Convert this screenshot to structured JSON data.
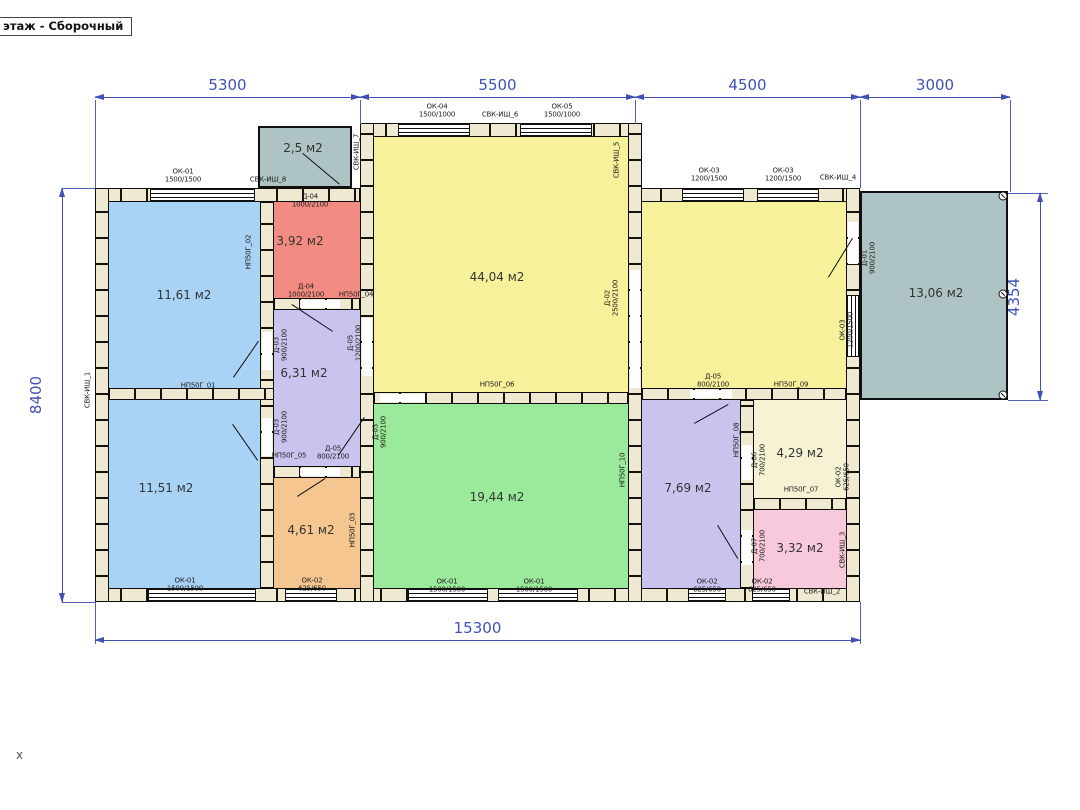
{
  "view_title": "этаж - Сборочный",
  "axis_label": "x",
  "colors": {
    "blue": "#a9d3f5",
    "red": "#f28c82",
    "lavender": "#c9c4ee",
    "orange": "#f6c690",
    "yellow": "#f6f19a",
    "green": "#9bea9b",
    "cream": "#f6f2d4",
    "pink": "#f8c8dc",
    "gray": "#aec3c3",
    "wall": "#efe9d2",
    "dim": "#3f51b5"
  },
  "rooms": [
    {
      "name": "room-11-61",
      "color": "blue",
      "x": 109,
      "y": 202,
      "w": 151,
      "h": 186
    },
    {
      "name": "room-11-51",
      "color": "blue",
      "x": 109,
      "y": 400,
      "w": 151,
      "h": 188
    },
    {
      "name": "room-3-92",
      "color": "red",
      "x": 274,
      "y": 202,
      "w": 86,
      "h": 96
    },
    {
      "name": "room-6-31",
      "color": "lavender",
      "x": 274,
      "y": 310,
      "w": 86,
      "h": 156
    },
    {
      "name": "room-4-61",
      "color": "orange",
      "x": 274,
      "y": 478,
      "w": 86,
      "h": 110
    },
    {
      "name": "room-44-04",
      "color": "yellow",
      "x": 374,
      "y": 137,
      "w": 254,
      "h": 255
    },
    {
      "name": "room-19-44",
      "color": "green",
      "x": 374,
      "y": 404,
      "w": 254,
      "h": 184
    },
    {
      "name": "room-right-hall",
      "color": "yellow",
      "x": 642,
      "y": 202,
      "w": 204,
      "h": 186
    },
    {
      "name": "room-7-69",
      "color": "lavender",
      "x": 642,
      "y": 400,
      "w": 98,
      "h": 188
    },
    {
      "name": "room-4-29",
      "color": "cream",
      "x": 754,
      "y": 400,
      "w": 92,
      "h": 98
    },
    {
      "name": "room-3-32",
      "color": "pink",
      "x": 754,
      "y": 510,
      "w": 92,
      "h": 78
    }
  ],
  "outbuildings": [
    {
      "name": "terrace",
      "color": "gray",
      "x": 860,
      "y": 191,
      "w": 148,
      "h": 209
    },
    {
      "name": "porch",
      "color": "gray",
      "x": 258,
      "y": 126,
      "w": 94,
      "h": 62
    }
  ],
  "walls": [
    {
      "name": "wall-top-left",
      "d": "h",
      "x": 95,
      "y": 188,
      "w": 265,
      "h": 14
    },
    {
      "name": "wall-top-center",
      "d": "h",
      "x": 360,
      "y": 123,
      "w": 275,
      "h": 14
    },
    {
      "name": "wall-top-right",
      "d": "h",
      "x": 635,
      "y": 188,
      "w": 225,
      "h": 14
    },
    {
      "name": "wall-bottom",
      "d": "h",
      "x": 95,
      "y": 588,
      "w": 765,
      "h": 14
    },
    {
      "name": "wall-left",
      "d": "v",
      "x": 95,
      "y": 188,
      "w": 14,
      "h": 414
    },
    {
      "name": "wall-right",
      "d": "v",
      "x": 846,
      "y": 188,
      "w": 14,
      "h": 414
    },
    {
      "name": "wall-center-left",
      "d": "v",
      "x": 360,
      "y": 123,
      "w": 14,
      "h": 479
    },
    {
      "name": "wall-center-right",
      "d": "v",
      "x": 628,
      "y": 123,
      "w": 14,
      "h": 479
    },
    {
      "name": "wall-left-mid",
      "d": "v",
      "x": 260,
      "y": 202,
      "w": 14,
      "h": 386
    },
    {
      "name": "wall-blue-divider",
      "d": "h",
      "x": 109,
      "y": 388,
      "w": 165,
      "h": 12
    },
    {
      "name": "wall-red-hall",
      "d": "h",
      "x": 274,
      "y": 298,
      "w": 86,
      "h": 12
    },
    {
      "name": "wall-hall-orange",
      "d": "h",
      "x": 274,
      "y": 466,
      "w": 86,
      "h": 12
    },
    {
      "name": "wall-yellow-green",
      "d": "h",
      "x": 374,
      "y": 392,
      "w": 254,
      "h": 12
    },
    {
      "name": "wall-right-mid-h",
      "d": "h",
      "x": 642,
      "y": 388,
      "w": 204,
      "h": 12
    },
    {
      "name": "wall-right-mid-v",
      "d": "v",
      "x": 740,
      "y": 400,
      "w": 14,
      "h": 188
    },
    {
      "name": "wall-cream-pink",
      "d": "h",
      "x": 754,
      "y": 498,
      "w": 92,
      "h": 12
    }
  ],
  "windows": [
    {
      "d": "h",
      "x": 150,
      "y": 189,
      "w": 105,
      "h": 12
    },
    {
      "d": "h",
      "x": 398,
      "y": 124,
      "w": 72,
      "h": 12
    },
    {
      "d": "h",
      "x": 520,
      "y": 124,
      "w": 72,
      "h": 12
    },
    {
      "d": "h",
      "x": 682,
      "y": 189,
      "w": 62,
      "h": 12
    },
    {
      "d": "h",
      "x": 757,
      "y": 189,
      "w": 62,
      "h": 12
    },
    {
      "d": "h",
      "x": 148,
      "y": 589,
      "w": 108,
      "h": 12
    },
    {
      "d": "h",
      "x": 285,
      "y": 589,
      "w": 52,
      "h": 12
    },
    {
      "d": "h",
      "x": 408,
      "y": 589,
      "w": 80,
      "h": 12
    },
    {
      "d": "h",
      "x": 498,
      "y": 589,
      "w": 80,
      "h": 12
    },
    {
      "d": "h",
      "x": 688,
      "y": 589,
      "w": 38,
      "h": 12
    },
    {
      "d": "h",
      "x": 752,
      "y": 589,
      "w": 38,
      "h": 12
    },
    {
      "d": "v",
      "x": 847,
      "y": 295,
      "w": 12,
      "h": 62
    }
  ],
  "door_gaps": [
    {
      "x": 848,
      "y": 222,
      "w": 10,
      "h": 42
    },
    {
      "x": 300,
      "y": 300,
      "w": 40,
      "h": 8
    },
    {
      "x": 362,
      "y": 318,
      "w": 10,
      "h": 58
    },
    {
      "x": 262,
      "y": 332,
      "w": 10,
      "h": 38
    },
    {
      "x": 262,
      "y": 418,
      "w": 10,
      "h": 38
    },
    {
      "x": 300,
      "y": 468,
      "w": 40,
      "h": 8
    },
    {
      "x": 380,
      "y": 394,
      "w": 45,
      "h": 8
    },
    {
      "x": 690,
      "y": 390,
      "w": 42,
      "h": 8
    },
    {
      "x": 630,
      "y": 270,
      "w": 10,
      "h": 118
    },
    {
      "x": 742,
      "y": 445,
      "w": 10,
      "h": 35
    },
    {
      "x": 742,
      "y": 530,
      "w": 10,
      "h": 35
    }
  ],
  "door_swings": [
    [
      303,
      153,
      340,
      184
    ],
    [
      233,
      377,
      258,
      341
    ],
    [
      233,
      424,
      258,
      460
    ],
    [
      292,
      304,
      333,
      331
    ],
    [
      338,
      455,
      364,
      417
    ],
    [
      297,
      496,
      325,
      478
    ],
    [
      828,
      277,
      852,
      238
    ],
    [
      694,
      423,
      728,
      404
    ],
    [
      718,
      525,
      738,
      558
    ]
  ],
  "screws": [
    [
      1003,
      196
    ],
    [
      1003,
      294
    ],
    [
      1003,
      395
    ]
  ],
  "area_labels": [
    {
      "t": "11,61 м2",
      "x": 184,
      "y": 295
    },
    {
      "t": "11,51 м2",
      "x": 166,
      "y": 488
    },
    {
      "t": "3,92 м2",
      "x": 300,
      "y": 241
    },
    {
      "t": "6,31 м2",
      "x": 304,
      "y": 373
    },
    {
      "t": "4,61 м2",
      "x": 311,
      "y": 530
    },
    {
      "t": "44,04 м2",
      "x": 497,
      "y": 277
    },
    {
      "t": "19,44 м2",
      "x": 497,
      "y": 497
    },
    {
      "t": "7,69 м2",
      "x": 688,
      "y": 488
    },
    {
      "t": "4,29 м2",
      "x": 800,
      "y": 453
    },
    {
      "t": "3,32 м2",
      "x": 800,
      "y": 548
    },
    {
      "t": "13,06 м2",
      "x": 936,
      "y": 293
    },
    {
      "t": "2,5 м2",
      "x": 303,
      "y": 148
    }
  ],
  "tag_labels": [
    {
      "t": "ОК-01\n1500/1500",
      "x": 183,
      "y": 176
    },
    {
      "t": "СВК-ИШ_8",
      "x": 268,
      "y": 180
    },
    {
      "t": "СВК-ИШ_7",
      "x": 357,
      "y": 152,
      "v": 1
    },
    {
      "t": "ОК-04\n1500/1000",
      "x": 437,
      "y": 111
    },
    {
      "t": "СВК-ИШ_6",
      "x": 500,
      "y": 115
    },
    {
      "t": "ОК-05\n1500/1000",
      "x": 562,
      "y": 111
    },
    {
      "t": "СВК-ИШ_5",
      "x": 617,
      "y": 160,
      "v": 1
    },
    {
      "t": "ОК-03\n1200/1500",
      "x": 709,
      "y": 175
    },
    {
      "t": "ОК-03\n1200/1500",
      "x": 783,
      "y": 175
    },
    {
      "t": "СВК-ИШ_4",
      "x": 838,
      "y": 178
    },
    {
      "t": "СВК-ИШ_1",
      "x": 88,
      "y": 390,
      "v": 1
    },
    {
      "t": "НП50Г_02",
      "x": 249,
      "y": 252,
      "v": 1
    },
    {
      "t": "Д-04\n1000/2100",
      "x": 310,
      "y": 201
    },
    {
      "t": "НП50Г_01",
      "x": 198,
      "y": 386
    },
    {
      "t": "Д-03\n900/2100",
      "x": 281,
      "y": 345,
      "v": 1
    },
    {
      "t": "Д-03\n900/2100",
      "x": 281,
      "y": 427,
      "v": 1
    },
    {
      "t": "Д-05\n1200/2100",
      "x": 355,
      "y": 343,
      "v": 1
    },
    {
      "t": "Д-04\n1000/2100",
      "x": 306,
      "y": 291
    },
    {
      "t": "НП50Г_04",
      "x": 356,
      "y": 295
    },
    {
      "t": "НП50Г_05",
      "x": 289,
      "y": 456
    },
    {
      "t": "Д-05\n800/2100",
      "x": 333,
      "y": 453
    },
    {
      "t": "НП50Г_03",
      "x": 353,
      "y": 530,
      "v": 1
    },
    {
      "t": "ОК-01\n1500/1500",
      "x": 185,
      "y": 585
    },
    {
      "t": "ОК-02\n625/650",
      "x": 312,
      "y": 585
    },
    {
      "t": "Д-02\n2500/2100",
      "x": 612,
      "y": 298,
      "v": 1
    },
    {
      "t": "НП50Г_06",
      "x": 497,
      "y": 385
    },
    {
      "t": "Д-03\n900/2100",
      "x": 380,
      "y": 432,
      "v": 1
    },
    {
      "t": "ОК-01\n1500/1500",
      "x": 447,
      "y": 586
    },
    {
      "t": "ОК-01\n1500/1500",
      "x": 534,
      "y": 586
    },
    {
      "t": "Д-05\n800/2100",
      "x": 713,
      "y": 381
    },
    {
      "t": "НП50Г_09",
      "x": 791,
      "y": 385
    },
    {
      "t": "НП50Г_10",
      "x": 623,
      "y": 470,
      "v": 1
    },
    {
      "t": "НП50Г_08",
      "x": 737,
      "y": 440,
      "v": 1
    },
    {
      "t": "Д-06\n700/2100",
      "x": 759,
      "y": 460,
      "v": 1
    },
    {
      "t": "НП50Г_07",
      "x": 801,
      "y": 490
    },
    {
      "t": "ОК-02\n625/650",
      "x": 843,
      "y": 477,
      "v": 1
    },
    {
      "t": "Д-07\n700/2100",
      "x": 759,
      "y": 546,
      "v": 1
    },
    {
      "t": "СВК-ИШ_3",
      "x": 843,
      "y": 550,
      "v": 1
    },
    {
      "t": "ОК-02\n625/650",
      "x": 707,
      "y": 586
    },
    {
      "t": "ОК-02\n625/650",
      "x": 762,
      "y": 586
    },
    {
      "t": "СВК-ИШ_2",
      "x": 822,
      "y": 592
    },
    {
      "t": "Д-01\n900/2100",
      "x": 869,
      "y": 258,
      "v": 1
    },
    {
      "t": "ОК-03\n1200/1500",
      "x": 847,
      "y": 330,
      "v": 1
    }
  ],
  "dimensions": [
    {
      "t": "5300",
      "d": "h",
      "x": 95,
      "y": 97,
      "len": 265
    },
    {
      "t": "5500",
      "d": "h",
      "x": 360,
      "y": 97,
      "len": 275
    },
    {
      "t": "4500",
      "d": "h",
      "x": 635,
      "y": 97,
      "len": 225
    },
    {
      "t": "3000",
      "d": "h",
      "x": 860,
      "y": 97,
      "len": 150
    },
    {
      "t": "15300",
      "d": "h",
      "x": 95,
      "y": 640,
      "len": 765
    },
    {
      "t": "8400",
      "d": "v",
      "x": 62,
      "y": 188,
      "len": 414
    },
    {
      "t": "4354",
      "d": "v",
      "x": 1040,
      "y": 193,
      "len": 207
    }
  ],
  "ext_lines": [
    {
      "d": "v",
      "x": 95,
      "y": 100,
      "len": 88
    },
    {
      "d": "v",
      "x": 360,
      "y": 100,
      "len": 24
    },
    {
      "d": "v",
      "x": 635,
      "y": 100,
      "len": 24
    },
    {
      "d": "v",
      "x": 860,
      "y": 100,
      "len": 88
    },
    {
      "d": "v",
      "x": 1010,
      "y": 100,
      "len": 92
    },
    {
      "d": "v",
      "x": 95,
      "y": 602,
      "len": 42
    },
    {
      "d": "v",
      "x": 860,
      "y": 602,
      "len": 42
    },
    {
      "d": "h",
      "x": 62,
      "y": 188,
      "len": 33
    },
    {
      "d": "h",
      "x": 62,
      "y": 602,
      "len": 33
    },
    {
      "d": "h",
      "x": 1008,
      "y": 193,
      "len": 40
    },
    {
      "d": "h",
      "x": 1008,
      "y": 400,
      "len": 40
    }
  ]
}
